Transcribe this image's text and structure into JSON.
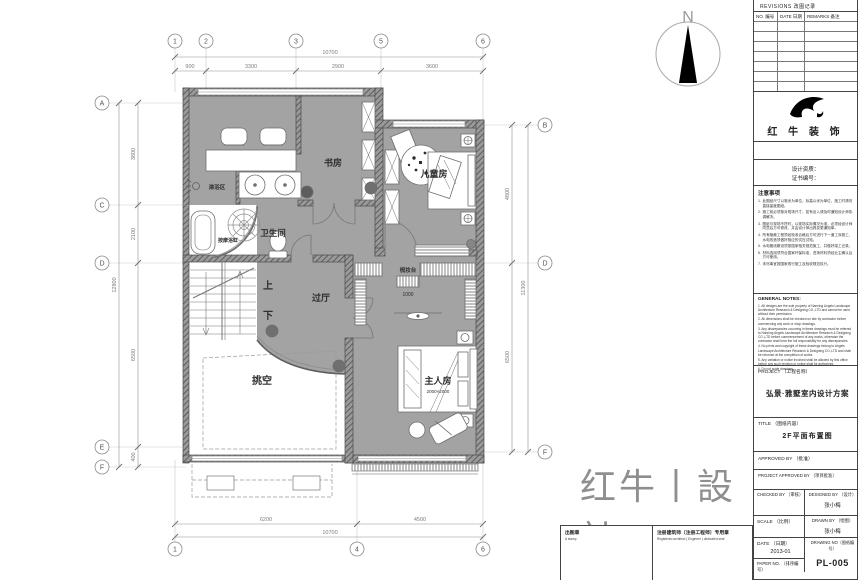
{
  "compass": {
    "north": "N"
  },
  "brand": {
    "cn": "红牛丨設計",
    "en": "HONGNIU DESIGN"
  },
  "plan": {
    "rooms": {
      "study": "书房",
      "kids": "儿童房",
      "bath": "卫生间",
      "shower": "淋浴区",
      "tub": "按摩浴缸",
      "hall": "过厅",
      "void": "挑空",
      "master": "主人房",
      "master_sub": "2000×2000",
      "dresser": "梳妆台",
      "dresser_sub": "1000",
      "up": "上",
      "down": "下"
    }
  },
  "grid": {
    "top": [
      "1",
      "2",
      "3",
      "5",
      "6"
    ],
    "bottom": [
      "1",
      "4",
      "6"
    ],
    "left": [
      "A",
      "C",
      "D",
      "E",
      "F"
    ],
    "right": [
      "B",
      "D",
      "F"
    ]
  },
  "dims": {
    "top": {
      "total": "10700",
      "segs": [
        "900",
        "3300",
        "2900",
        "3600"
      ]
    },
    "bottom": {
      "total": "10700",
      "segs": [
        "6200",
        "4500"
      ]
    },
    "left": {
      "total": "12800",
      "segs": [
        "3800",
        "2100",
        "6500",
        "400"
      ]
    },
    "right": {
      "total": "11300",
      "segs": [
        "4800",
        "6500"
      ]
    }
  },
  "titleblock": {
    "revisions": "REVISIONS  改图记录",
    "rev_col_no": "NO. 编号",
    "rev_col_date": "DATE 日期",
    "rev_col_remarks": "REMARKS 备注",
    "company": "红 牛 装 饰",
    "cred1": "设计资质：",
    "cred2": "证书编号：",
    "notes_cn_title": "注意事项",
    "notes_cn": [
      "此图纸尺寸以毫米为单位，标高以米为单位，施工时请勿直接量度图纸。",
      "施工前必须核对现场尺寸，如有出入请及时通知设计师协调解决。",
      "图纸与现场不符时，以现场实际情况为准，必须经设计师同意后方可修改，并由设计师出具变更通知单。",
      "所有隐蔽工程须经验收合格后方可进行下一道工序施工，水电改造须做好相应的试压试验。",
      "水电管线敷设须按国家相关规范施工，并做好竣工记录。",
      "材料选用须符合国家环保标准，进场材料须经业主确认后方可使用。",
      "未尽事宜按国家现行施工及验收规范执行。"
    ],
    "notes_en_title": "GENERAL NOTES:",
    "notes_en": [
      "1. All designs are the sole property of Nanning Angels Landscape Architecture Research & Designing CO.,LTD and cannot be used without their permission.",
      "2. All dimensions shall be checked on site by contractor before commencing any work or shop drawings.",
      "3. Any discrepancies occurring in these drawings must be referred to Nanning Angels Landscape Architecture Research & Designing CO.,LTD before commencement of any works, otherwise the contractor shall bear the full responsibility for any discrepancies.",
      "4. No prints and copyright of these drawings belong to Angels Landscape Architecture Research & Designing CO.,LTD and shall be returned at the completion of works.",
      "5. Any variation or notice involved shall be allowed by this office before any such revision or notice shall be authorized.",
      "6. Do not scale drawings."
    ],
    "project_label": "PROJECT （工程名称）",
    "project_name": "弘景·雅墅室内设计方案",
    "title_label": "TITLE （图纸内容）",
    "title_value": "2F平面布置图",
    "approved_label": "APPROVED BY （批准）",
    "proj_approved_label": "PROJECT APPROVED BY （项目批准）",
    "checked_label": "CHECKED BY （审核）",
    "designed_label": "DESIGNED BY （设计）",
    "designer": "张小梅",
    "scale_label": "SCALE （比例）",
    "drawn_label": "DRAWN BY （绘图）",
    "drafter": "张小梅",
    "date_label": "DATE （日期）",
    "date_value": "2013-01",
    "dwg_label": "DRAWING NO（图纸编号）",
    "dwg_no": "PL-005",
    "paper_label": "PAPER NO. （排序编号）",
    "stamp1": "出图章",
    "stamp1_en": "A stamp",
    "stamp2": "注册建筑师〔注册工程师〕专用章",
    "stamp2_en": "Registered architect ( Engineer ) dedicated seal"
  }
}
